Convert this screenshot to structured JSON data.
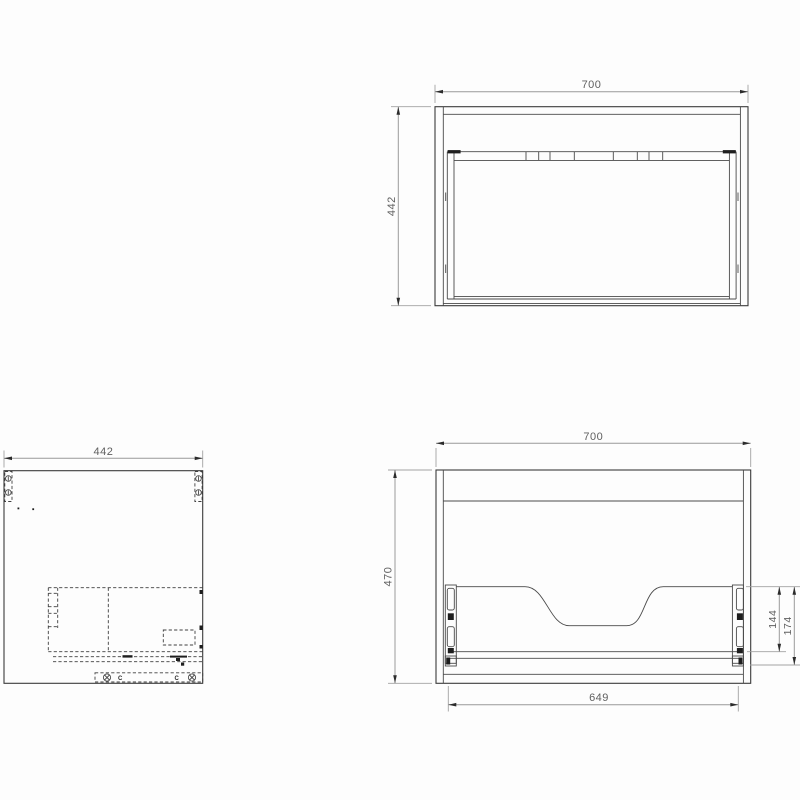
{
  "drawing": {
    "type": "technical-cad-drawing",
    "subject": "wall-hung vanity cabinet with drawer",
    "views": {
      "top_view": "plan view of cabinet carcass with drawer box",
      "side_view": "side elevation with hidden drawer runner details",
      "rear_view": "rear elevation with drawer back cutout and runners"
    }
  },
  "dimensions": {
    "top": {
      "width": "700",
      "depth": "442"
    },
    "side": {
      "depth": "442"
    },
    "rear": {
      "width": "700",
      "height": "470",
      "bottom_width": "649",
      "runner_height": "144",
      "runner_assembly_height": "174"
    }
  },
  "labels": {
    "clip_left": "C",
    "clip_right": "C"
  },
  "colors": {
    "background": "#fdfdfd",
    "drawing_lines": "#3a3a3a",
    "dimension_lines": "#9a9a9a",
    "dimension_text": "#5f5f5f",
    "arrowheads": "#2b2b2b"
  }
}
